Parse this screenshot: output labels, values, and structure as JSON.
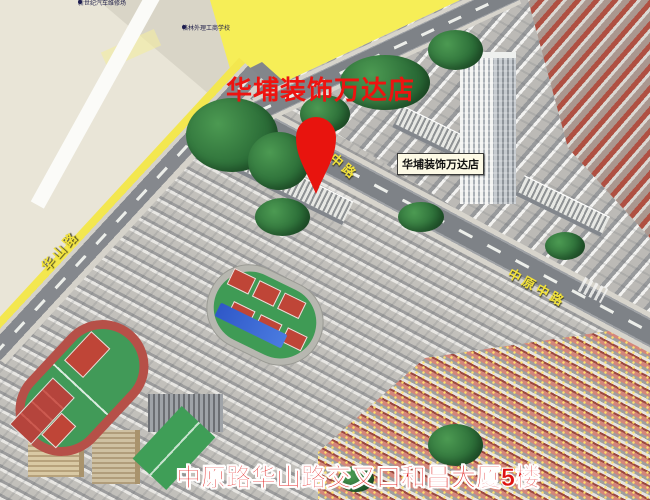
{
  "title": "华埔装饰万达店",
  "marker": {
    "label": "华埔装饰万达店"
  },
  "address": "中原路华山路交叉口和昌大厦5楼",
  "roads": {
    "huashan": "华山路",
    "zhongyuan_upper": "原中路",
    "zhongyuan_mid": "中原中路"
  },
  "pois": [
    {
      "label": "新世纪汽车维修场"
    },
    {
      "label": "格林外理工商学校"
    }
  ],
  "colors": {
    "accent_red": "#ee1310",
    "pin_red": "#e8140e",
    "road_label_yellow": "#f2e23a",
    "flat_map_yellow": "#f6ee57",
    "label_box_bg": "#fdfae6",
    "asphalt": "#7e8287",
    "field_green": "#3f9b55",
    "court_red": "#bf4537"
  }
}
